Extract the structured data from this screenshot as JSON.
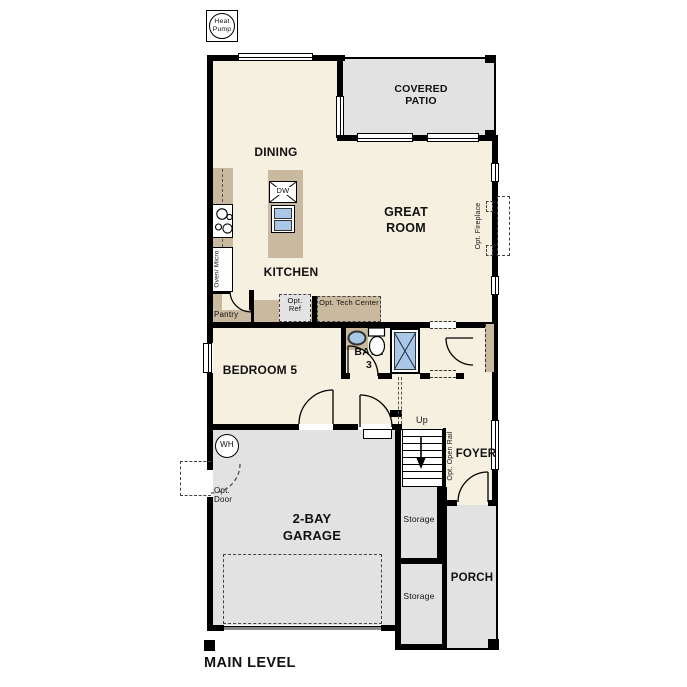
{
  "plan_title": "MAIN LEVEL",
  "colors": {
    "floor": "#f6f0e1",
    "outdoor_concrete": "#e2e2e2",
    "cabinet_tan": "#c9b99e",
    "fixture_blue": "#a9c8e8",
    "wall": "#000000"
  },
  "rooms": {
    "dining": "DINING",
    "covered_patio": "COVERED PATIO",
    "great_room": "GREAT ROOM",
    "kitchen": "KITCHEN",
    "bedroom_5": "BEDROOM 5",
    "bath_3": "BATH 3",
    "foyer": "FOYER",
    "garage": "2-BAY GARAGE",
    "porch": "PORCH",
    "storage_upper": "Storage",
    "storage_lower": "Storage",
    "pantry": "Pantry"
  },
  "options": {
    "ref": "Opt. Ref",
    "tech_center": "Opt. Tech Center",
    "fireplace": "Opt. Fireplace",
    "open_rail": "Opt. Open Rail",
    "door": "Opt. Door"
  },
  "fixtures": {
    "heat_pump": "Heat Pump",
    "water_heater": "WH",
    "dishwasher": "DW",
    "oven_micro": "Oven/ Micro",
    "stairs_direction": "Up"
  }
}
